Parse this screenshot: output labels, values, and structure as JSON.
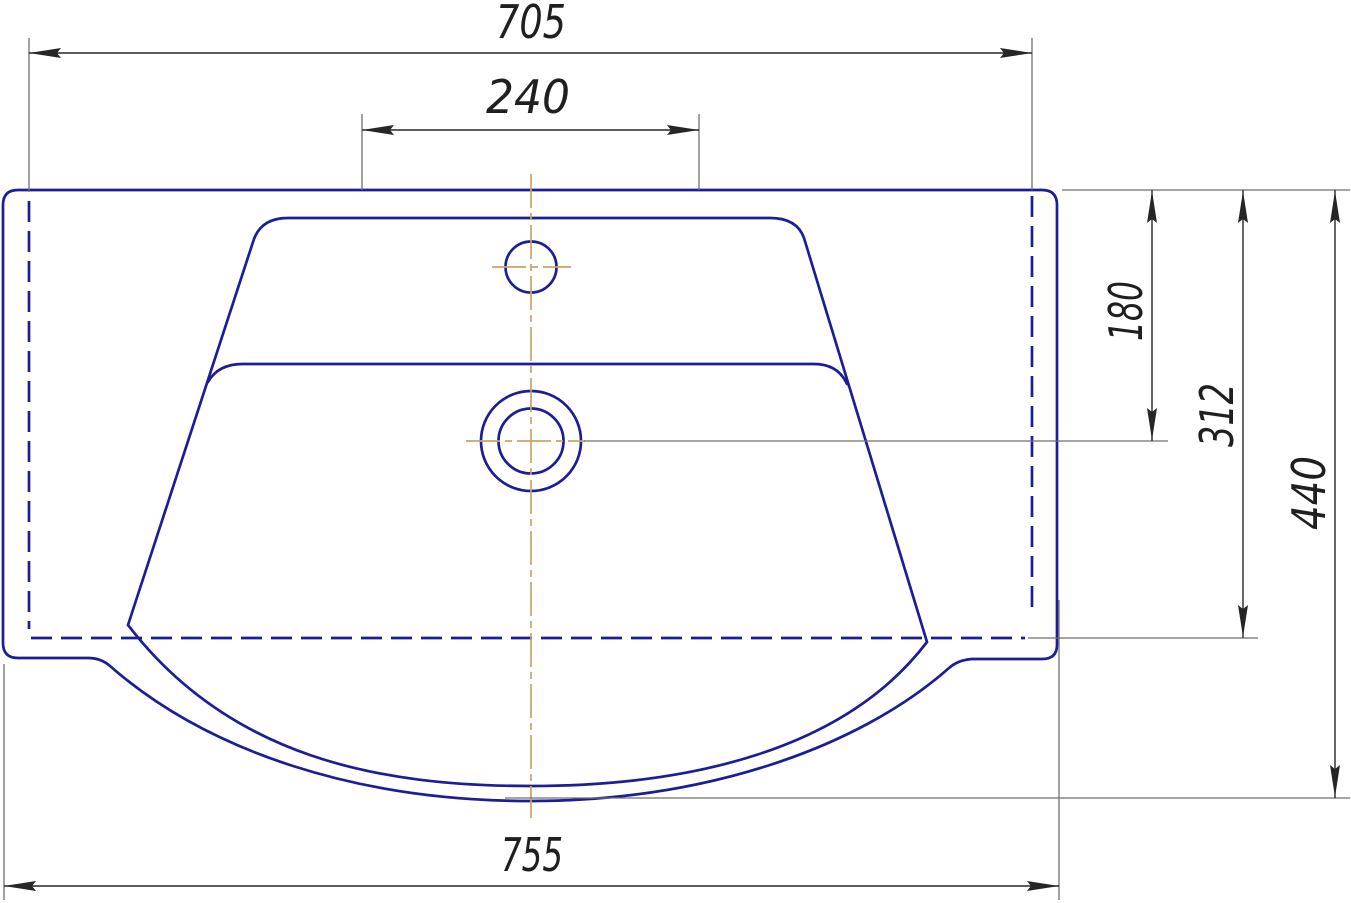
{
  "dims": {
    "top_width": "705",
    "faucet_offset": "240",
    "depth_to_drain": "180",
    "depth_to_recess": "312",
    "overall_depth": "440",
    "bottom_width": "755"
  },
  "colors": {
    "outline": "#1d1d96",
    "centerline": "#cda266",
    "dimension": "#262626",
    "extension": "#6f6f6f",
    "background": "#ffffff"
  }
}
